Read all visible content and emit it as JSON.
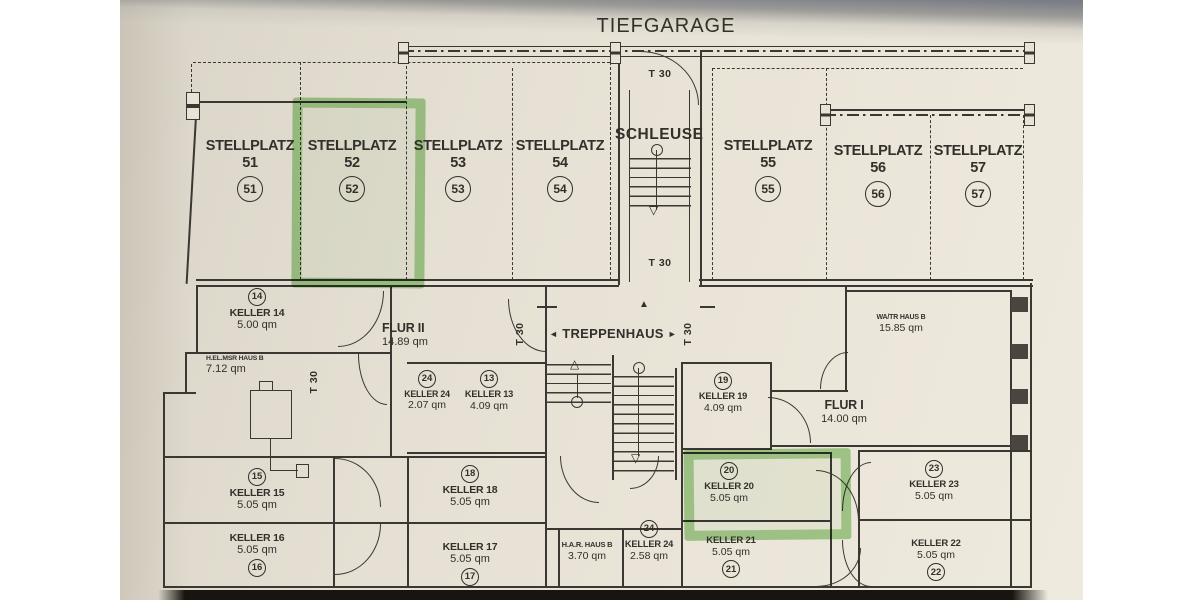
{
  "title": "TIEFGARAGE",
  "t30": "T 30",
  "arrows": {
    "left": "◄",
    "right": "►",
    "up": "▲",
    "up_outline": "△",
    "down_outline": "▽"
  },
  "garage": {
    "schleuse": "SCHLEUSE",
    "stellplaetze": [
      {
        "label": "STELLPLATZ 51",
        "number": "51"
      },
      {
        "label": "STELLPLATZ 52",
        "number": "52"
      },
      {
        "label": "STELLPLATZ 53",
        "number": "53"
      },
      {
        "label": "STELLPLATZ 54",
        "number": "54"
      },
      {
        "label": "STELLPLATZ 55",
        "number": "55"
      },
      {
        "label": "STELLPLATZ 56",
        "number": "56"
      },
      {
        "label": "STELLPLATZ 57",
        "number": "57"
      }
    ],
    "highlighted_stellplatz": "52"
  },
  "stairwell": {
    "label": "TREPPENHAUS"
  },
  "rooms": {
    "keller14": {
      "number": "14",
      "name": "KELLER 14",
      "area": "5.00 qm"
    },
    "elmsr": {
      "name": "H.EL.MSR HAUS B",
      "area": "7.12 qm"
    },
    "flur2": {
      "name": "FLUR II",
      "area": "14.89 qm"
    },
    "keller24a": {
      "number": "24",
      "name": "KELLER 24",
      "area": "2.07 qm"
    },
    "keller13": {
      "number": "13",
      "name": "KELLER 13",
      "area": "4.09 qm"
    },
    "keller19": {
      "number": "19",
      "name": "KELLER 19",
      "area": "4.09 qm"
    },
    "flur1": {
      "name": "FLUR I",
      "area": "14.00 qm"
    },
    "watr": {
      "name": "WA/TR HAUS B",
      "area": "15.85 qm"
    },
    "keller15": {
      "number": "15",
      "name": "KELLER 15",
      "area": "5.05 qm"
    },
    "keller18": {
      "number": "18",
      "name": "KELLER 18",
      "area": "5.05 qm"
    },
    "keller20": {
      "number": "20",
      "name": "KELLER 20",
      "area": "5.05 qm",
      "highlighted": true
    },
    "keller23": {
      "number": "23",
      "name": "KELLER 23",
      "area": "5.05 qm"
    },
    "keller16": {
      "number": "16",
      "name": "KELLER 16",
      "area": "5.05 qm"
    },
    "keller17": {
      "number": "17",
      "name": "KELLER 17",
      "area": "5.05 qm"
    },
    "har": {
      "name": "H.A.R. HAUS B",
      "area": "3.70 qm"
    },
    "keller24b": {
      "number": "24",
      "name": "KELLER 24",
      "area": "2.58 qm"
    },
    "keller21": {
      "number": "21",
      "name": "KELLER 21",
      "area": "5.05 qm"
    },
    "keller22": {
      "number": "22",
      "name": "KELLER 22",
      "area": "5.05 qm"
    }
  },
  "highlight": {
    "color": "#6eba54",
    "highlighted_items": [
      "STELLPLATZ 52",
      "KELLER 20"
    ]
  }
}
